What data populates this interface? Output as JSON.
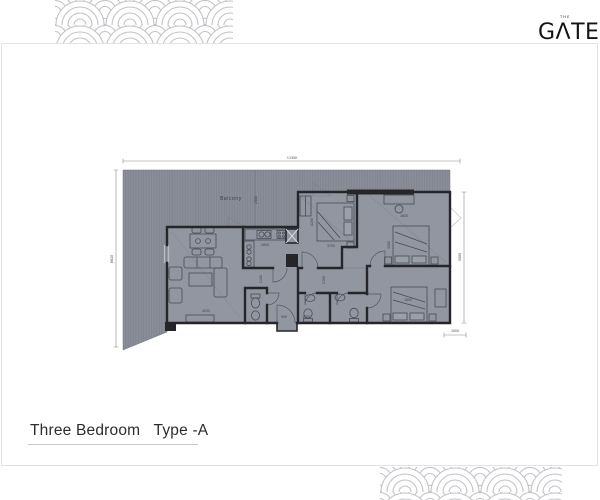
{
  "logo": {
    "text": "GΛTE",
    "tagline": "THE"
  },
  "title": {
    "text": "Three Bedroom   Type -A"
  },
  "plan": {
    "room_labels": [
      {
        "text": "Balcony",
        "x": 231,
        "y": 200
      }
    ],
    "dimensions": [
      {
        "text": "11300",
        "x": 292,
        "y": 159,
        "rot": 0
      },
      {
        "text": "8610",
        "x": 113,
        "y": 259,
        "rot": -90
      },
      {
        "text": "2300",
        "x": 257,
        "y": 200,
        "rot": -90
      },
      {
        "text": "5000",
        "x": 461,
        "y": 257,
        "rot": -90
      },
      {
        "text": "1000",
        "x": 455,
        "y": 332,
        "rot": 0
      },
      {
        "text": "4250",
        "x": 206,
        "y": 312,
        "rot": 0
      },
      {
        "text": "3700",
        "x": 331,
        "y": 247,
        "rot": 0
      },
      {
        "text": "4200",
        "x": 313,
        "y": 222,
        "rot": -90
      },
      {
        "text": "1800",
        "x": 404,
        "y": 217,
        "rot": 0
      },
      {
        "text": "3400",
        "x": 390,
        "y": 245,
        "rot": -90
      },
      {
        "text": "1800",
        "x": 408,
        "y": 301,
        "rot": 0
      },
      {
        "text": "1100",
        "x": 262,
        "y": 279,
        "rot": -90
      },
      {
        "text": "1100",
        "x": 325,
        "y": 280,
        "rot": -90
      },
      {
        "text": "900",
        "x": 284,
        "y": 318,
        "rot": 0
      },
      {
        "text": "1525",
        "x": 306,
        "y": 318,
        "rot": 0
      },
      {
        "text": "2600",
        "x": 265,
        "y": 246,
        "rot": 0
      }
    ],
    "colors": {
      "terrace": "#8a8e99",
      "stripe": "#7d818b",
      "room": "#9196a1",
      "wall": "#26262a",
      "furniture": "#474b55",
      "dimension_text": "#3f4046",
      "wave_pattern": "#c2c3c7",
      "card_border": "#e3e3e7"
    }
  }
}
